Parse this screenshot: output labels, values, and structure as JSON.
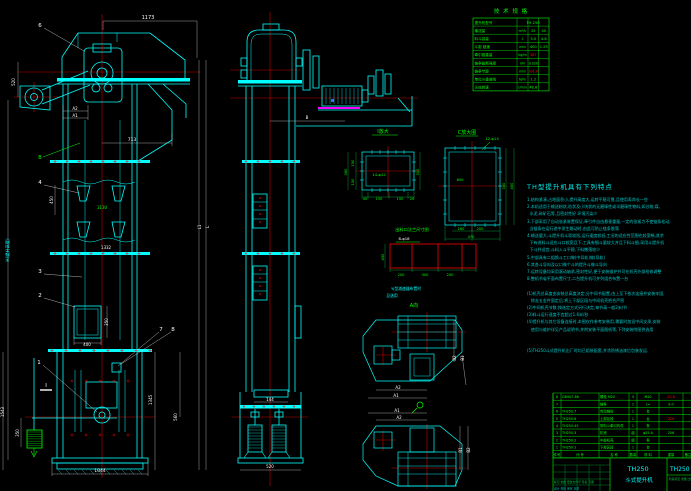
{
  "colors": {
    "cyan": "#00ffff",
    "green": "#00ff00",
    "red": "#ff0000",
    "yellow": "#ffff00",
    "magenta": "#ff00ff",
    "white": "#ffffff",
    "blue": "#3366ff"
  },
  "drawing": {
    "tech_table": {
      "title": "技 术 规 格",
      "red_rows": [
        4,
        6
      ],
      "rows": [
        [
          "提升机型号",
          "",
          "TH 250",
          ""
        ],
        [
          "输送量",
          "m³/h",
          "25",
          "40"
        ],
        [
          "料斗容量",
          "L",
          "3.0",
          "4.8"
        ],
        [
          "斗距 链速",
          "mm",
          "400",
          "1.25"
        ],
        [
          "牵引链重量",
          "kg/m",
          "387",
          ""
        ],
        [
          "链条破断强度",
          "kN",
          "≥320",
          ""
        ],
        [
          "链条节距",
          "mm",
          "101.6",
          ""
        ],
        [
          "单位斗重曲线",
          "N/m",
          "1.2",
          ""
        ],
        [
          "头轮转速",
          "r/min",
          "48.8",
          ""
        ]
      ]
    },
    "features": {
      "title": "TH型提升机具有下列特点",
      "lines": [
        "1.结构紧凑,占地面积小,提升高度大,运转平稳可靠,且使用寿命长一些",
        "2.本机适用于输送粉状,粒状及小块状的无磨琢性或半磨琢性物料,如谷物,煤,",
        "  水泥,碎矿石等,且密封性好 环境污染少",
        "3.下部采用了自动张紧装置保证,牵引件自由悬垂重量,一定的张紧力不使链条松动,",
        "  当链条在运行途中发生跳动时,由此可防止链条脱落",
        "4.输送量大,斗提升机斗距较短,运行速度较低,工况的适应性范围也较宽畅,其余",
        "  下有进料斗适应斗口较宽且下,工具有细斗量较大并且下料斗细,采用斗提升机",
        "  下斗并适宜,斗料入斗平稳,下料撒落较少",
        "5.中部具有二组换斗工口做(中导轨)做(导轨)",
        "6.其各斗导向及以口做个斗的提升斗做斗导向",
        "7.运转设备均采用滚动轴承,密封性好,便于安装维护并可在机壳外部检修调整",
        "8.整机节省平面布置尺寸,二台提升机可并列组合布置一台",
        "",
        "(1)机壳总高度由安装总高度决定,分中间节配置,由上至下依次连接并安装牢固,",
        "   除去五金件固定后,将上下部区段与中间机壳把合严密",
        "(2)中间机壳节数:按选定方式另行决定,每节高一般2米/节",
        "(3)料斗运行速度不宜超过1.6米/秒",
        "(4)提升机与其它设备连接时,本图仅作参考安装用,需要时加设中间支承,安装",
        "   使用与维护详见产品说明书,并附安装平面图纸等,下列安装附图供选用",
        "",
        "",
        "(5)TH250斗式提升机出厂时均已组装配套,并涂防锈油漆后包装发运."
      ]
    },
    "bom": {
      "headers": [
        "件号",
        "代  号",
        "名  称",
        "数量",
        "材 料",
        "重量",
        "备注"
      ],
      "rows": [
        [
          "8",
          "GB907-86",
          "螺栓 M20",
          "4",
          "M20",
          "20.8",
          "r"
        ],
        [
          "7",
          "",
          "链条",
          "1",
          "L=",
          "9.0",
          ""
        ],
        [
          "6",
          "TH250.7",
          "传动链轮",
          "1",
          "台",
          "",
          ""
        ],
        [
          "5",
          "TH250.6",
          "上部区段",
          "1",
          "台",
          "226",
          "r"
        ],
        [
          "4",
          "TH250.45",
          "带料斗牵引构件",
          "1",
          "条",
          "",
          ""
        ],
        [
          "3",
          "TH250.3",
          "机壳",
          "组",
          "φ25-A",
          "206",
          ""
        ],
        [
          "2",
          "TH250.2",
          "中部机壳",
          "组",
          "条",
          "",
          ""
        ],
        [
          "1",
          "TH250.1",
          "下部区段",
          "1",
          "台",
          "",
          ""
        ]
      ]
    },
    "title_block": {
      "model": "TH250",
      "product": "斗式提升机",
      "drawing_no": "TH250",
      "stage_row": "阶段标记  重量  比例",
      "revision_row": "标记 处数 更改文件号 签名 日期",
      "sign_row": "设计    校核    审定    日期"
    },
    "labels": [
      {
        "t": "1173",
        "x": 148,
        "y": 19,
        "s": 5
      },
      {
        "t": "6",
        "x": 40,
        "y": 27,
        "s": 5.5
      },
      {
        "t": "A2",
        "x": 75,
        "y": 110,
        "s": 4
      },
      {
        "t": "A1",
        "x": 75,
        "y": 117,
        "s": 4
      },
      {
        "t": "520",
        "x": 15,
        "y": 82,
        "r": -90,
        "s": 4
      },
      {
        "t": "B",
        "x": 40,
        "y": 159,
        "c": "green",
        "s": 5
      },
      {
        "t": "713",
        "x": 132,
        "y": 141,
        "s": 4.5
      },
      {
        "t": "4",
        "x": 40,
        "y": 184,
        "s": 5.5
      },
      {
        "t": "450",
        "x": 53,
        "y": 200,
        "r": -90,
        "s": 4
      },
      {
        "t": "1130",
        "x": 102,
        "y": 209,
        "c": "green",
        "s": 4
      },
      {
        "t": "1332",
        "x": 106,
        "y": 249,
        "s": 4
      },
      {
        "t": "3",
        "x": 40,
        "y": 273,
        "s": 5.5
      },
      {
        "t": "2",
        "x": 40,
        "y": 297,
        "s": 5.5
      },
      {
        "t": "H(提升高度)",
        "x": 9,
        "y": 250,
        "r": -90,
        "c": "cyan",
        "s": 4.2
      },
      {
        "t": "L1",
        "x": 201,
        "y": 227,
        "r": -90,
        "s": 4
      },
      {
        "t": "L",
        "x": 209,
        "y": 227,
        "r": -90,
        "s": 4.5
      },
      {
        "t": "350",
        "x": 108,
        "y": 322,
        "r": -90,
        "s": 4
      },
      {
        "t": "400",
        "x": 87,
        "y": 346,
        "s": 4
      },
      {
        "t": "7",
        "x": 161,
        "y": 331,
        "s": 5.5
      },
      {
        "t": "8",
        "x": 173,
        "y": 331,
        "s": 5.5
      },
      {
        "t": "1",
        "x": 39,
        "y": 364,
        "s": 5.5
      },
      {
        "t": "I",
        "x": 46,
        "y": 387,
        "s": 5.5
      },
      {
        "t": "1345",
        "x": 152,
        "y": 400,
        "r": -90,
        "s": 4
      },
      {
        "t": "560",
        "x": 177,
        "y": 417,
        "r": -90,
        "s": 4
      },
      {
        "t": "1543",
        "x": 4,
        "y": 412,
        "r": -90,
        "s": 4
      },
      {
        "t": "350",
        "x": 19,
        "y": 433,
        "r": -90,
        "s": 4
      },
      {
        "t": "1044",
        "x": 100,
        "y": 472,
        "s": 4.5
      },
      {
        "t": "B",
        "x": 307,
        "y": 119,
        "s": 4
      },
      {
        "t": "144",
        "x": 270,
        "y": 401,
        "s": 4
      },
      {
        "t": "520",
        "x": 270,
        "y": 468,
        "s": 4
      },
      {
        "t": "I放大",
        "x": 383,
        "y": 133,
        "c": "green",
        "s": 5
      },
      {
        "t": "14-φ12",
        "x": 379,
        "y": 176,
        "c": "green",
        "s": 3.8
      },
      {
        "t": "150",
        "x": 354,
        "y": 163,
        "r": -90,
        "c": "green",
        "s": 3.6
      },
      {
        "t": "150",
        "x": 354,
        "y": 182,
        "r": -90,
        "c": "green",
        "s": 3.6
      },
      {
        "t": "360",
        "x": 347,
        "y": 172,
        "r": -90,
        "c": "green",
        "s": 3.6
      },
      {
        "t": "300",
        "x": 419,
        "y": 172,
        "r": -90,
        "c": "green",
        "s": 3.6
      },
      {
        "t": "40",
        "x": 365,
        "y": 200,
        "c": "green",
        "s": 3.6
      },
      {
        "t": "150",
        "x": 379,
        "y": 200,
        "c": "green",
        "s": 3.6
      },
      {
        "t": "150",
        "x": 400,
        "y": 200,
        "c": "green",
        "s": 3.6
      },
      {
        "t": "20",
        "x": 412,
        "y": 200,
        "c": "green",
        "s": 3.6
      },
      {
        "t": "C放大图",
        "x": 467,
        "y": 134,
        "c": "green",
        "s": 5
      },
      {
        "t": "12-φ14",
        "x": 492,
        "y": 140,
        "c": "green",
        "s": 3.8
      },
      {
        "t": "600",
        "x": 460,
        "y": 181,
        "c": "green",
        "s": 3.6
      },
      {
        "t": "300",
        "x": 505,
        "y": 186,
        "r": -90,
        "c": "green",
        "s": 3.6
      },
      {
        "t": "450",
        "x": 513,
        "y": 186,
        "r": -90,
        "c": "green",
        "s": 3.6
      },
      {
        "t": "160",
        "x": 461,
        "y": 230,
        "c": "green",
        "s": 3.6
      },
      {
        "t": "200",
        "x": 480,
        "y": 230,
        "c": "green",
        "s": 3.6
      },
      {
        "t": "470",
        "x": 471,
        "y": 238,
        "c": "green",
        "s": 3.6
      },
      {
        "t": "出料口法兰尺寸图",
        "x": 412,
        "y": 231,
        "c": "green",
        "s": 4.2
      },
      {
        "t": "8-φ18",
        "x": 404,
        "y": 240,
        "c": "white",
        "s": 3.8
      },
      {
        "t": "450",
        "x": 384,
        "y": 257,
        "r": -90,
        "c": "green",
        "s": 3.6
      },
      {
        "t": "200",
        "x": 401,
        "y": 276,
        "c": "green",
        "s": 3.6
      },
      {
        "t": "300",
        "x": 425,
        "y": 276,
        "c": "green",
        "s": 3.6
      },
      {
        "t": "200",
        "x": 450,
        "y": 276,
        "c": "green",
        "s": 3.6
      },
      {
        "t": "YJ型减速器布置时",
        "x": 406,
        "y": 290,
        "c": "cyan",
        "s": 3.8
      },
      {
        "t": "见选用",
        "x": 392,
        "y": 297,
        "c": "cyan",
        "s": 3.8
      },
      {
        "t": "A向",
        "x": 414,
        "y": 307,
        "c": "green",
        "s": 5
      },
      {
        "t": "A2",
        "x": 398,
        "y": 389,
        "s": 4
      },
      {
        "t": "A1",
        "x": 396,
        "y": 397,
        "s": 4
      },
      {
        "t": "B2",
        "x": 456,
        "y": 358,
        "r": -90,
        "s": 4
      },
      {
        "t": "B1",
        "x": 464,
        "y": 358,
        "r": -90,
        "s": 4
      },
      {
        "t": "A1",
        "x": 397,
        "y": 412,
        "s": 4
      },
      {
        "t": "A2",
        "x": 399,
        "y": 419,
        "s": 4
      },
      {
        "t": "B1",
        "x": 462,
        "y": 450,
        "r": -90,
        "s": 4
      },
      {
        "t": "B2",
        "x": 470,
        "y": 450,
        "r": -90,
        "s": 4
      }
    ]
  }
}
